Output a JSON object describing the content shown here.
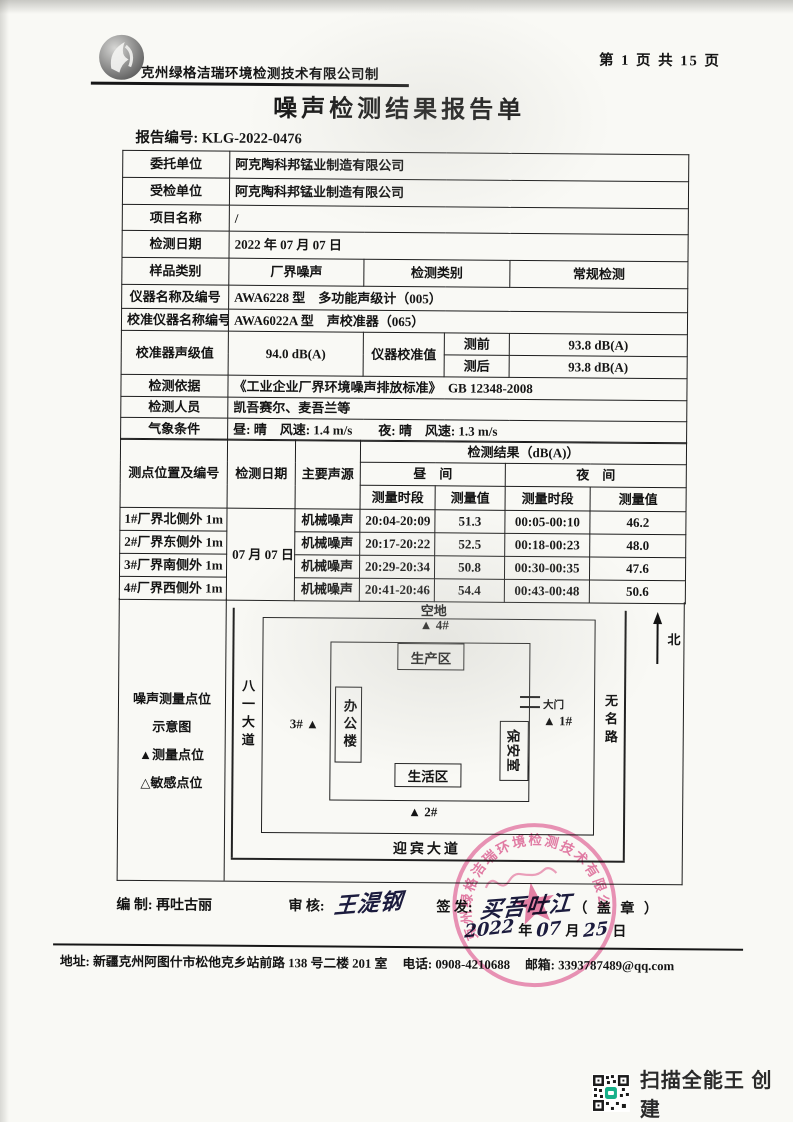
{
  "header": {
    "maker": "克州绿格洁瑞环境检测技术有限公司制",
    "page_info": "第 1 页 共 15 页",
    "title": "噪声检测结果报告单",
    "report_no_label": "报告编号: ",
    "report_no": "KLG-2022-0476"
  },
  "info": {
    "client": {
      "label": "委托单位",
      "value": "阿克陶科邦锰业制造有限公司"
    },
    "inspected": {
      "label": "受检单位",
      "value": "阿克陶科邦锰业制造有限公司"
    },
    "project": {
      "label": "项目名称",
      "value": "/"
    },
    "date": {
      "label": "检测日期",
      "value": "2022 年 07 月 07 日"
    },
    "sample": {
      "label": "样品类别",
      "value": "厂界噪声",
      "label2": "检测类别",
      "value2": "常规检测"
    },
    "instrument": {
      "label": "仪器名称及编号",
      "value": "AWA6228 型　多功能声级计（005）"
    },
    "calibrator": {
      "label": "校准仪器名称编号",
      "value": "AWA6022A 型　声校准器（065）"
    },
    "cal_level": {
      "label": "校准器声级值",
      "value": "94.0 dB(A)",
      "label2": "仪器校准值",
      "pre_label": "测前",
      "pre_value": "93.8 dB(A)",
      "post_label": "测后",
      "post_value": "93.8 dB(A)"
    },
    "basis": {
      "label": "检测依据",
      "value": "《工业企业厂界环境噪声排放标准》　GB 12348-2008"
    },
    "personnel": {
      "label": "检测人员",
      "value": "凯吾赛尔、麦吾兰等"
    },
    "weather": {
      "label": "气象条件",
      "value": "昼: 晴　风速: 1.4 m/s　　夜: 晴　风速: 1.3 m/s"
    }
  },
  "results": {
    "col_point": "测点位置及编号",
    "col_date": "检测日期",
    "col_source": "主要声源",
    "col_result": "检测结果（dB(A)）",
    "col_day": "昼　间",
    "col_night": "夜　间",
    "col_period": "测量时段",
    "col_value": "测量值",
    "date_value": "07 月 07 日",
    "rows": [
      {
        "point": "1#厂界北侧外 1m",
        "source": "机械噪声",
        "day_period": "20:04-20:09",
        "day_value": "51.3",
        "night_period": "00:05-00:10",
        "night_value": "46.2"
      },
      {
        "point": "2#厂界东侧外 1m",
        "source": "机械噪声",
        "day_period": "20:17-20:22",
        "day_value": "52.5",
        "night_period": "00:18-00:23",
        "night_value": "48.0"
      },
      {
        "point": "3#厂界南侧外 1m",
        "source": "机械噪声",
        "day_period": "20:29-20:34",
        "day_value": "50.8",
        "night_period": "00:30-00:35",
        "night_value": "47.6"
      },
      {
        "point": "4#厂界西侧外 1m",
        "source": "机械噪声",
        "day_period": "20:41-20:46",
        "day_value": "54.4",
        "night_period": "00:43-00:48",
        "night_value": "50.6"
      }
    ]
  },
  "diagram": {
    "legend": {
      "line1": "噪声测量点位",
      "line2": "示意图",
      "item1": "▲测量点位",
      "item2": "△敏感点位"
    },
    "open_space": "空地",
    "north": "北",
    "road_left": "八一大道",
    "road_right": "无名路",
    "road_bottom": "迎宾大道",
    "production": "生产区",
    "office": "办公楼",
    "living": "生活区",
    "guard": "保安室",
    "gate": "大门",
    "p1": "▲ 1#",
    "p2": "▲ 2#",
    "p3": "3# ▲",
    "p4": "▲ 4#"
  },
  "signature": {
    "prepared_label": "编 制: ",
    "prepared_name": "再吐古丽",
    "review_label": "审 核: ",
    "review_signature": "王湜钢",
    "issue_label": "签 发: ",
    "issue_signature": "买吾吐江",
    "seal_note": "（ 盖 章 ）",
    "date": {
      "year": "2022",
      "year_unit": "年",
      "month": "07",
      "month_unit": "月",
      "day": "25",
      "day_unit": "日"
    }
  },
  "stamp": {
    "ring_text": "克州绿格洁瑞环境检测技术有限公司",
    "color": "#d9558a"
  },
  "footer": {
    "address": "地址: 新疆克州阿图什市松他克乡站前路 138 号二楼 201 室",
    "phone": "电话: 0908-4210688",
    "email": "邮箱: 3393787489@qq.com"
  },
  "camscanner": {
    "label": "扫描全能王 创建"
  }
}
